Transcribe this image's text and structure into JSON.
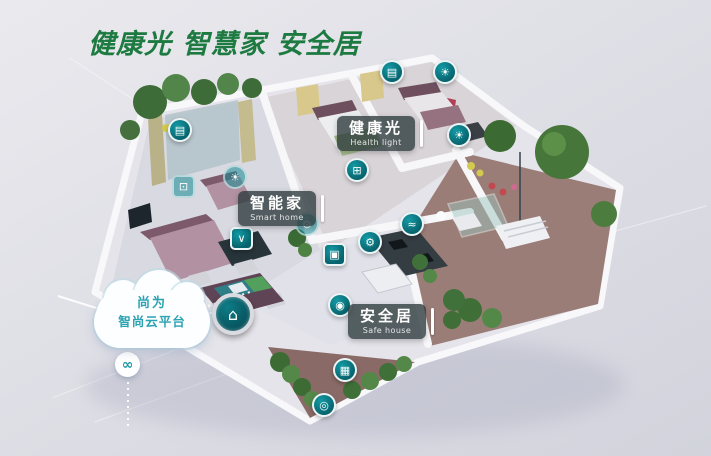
{
  "title": "健康光 智慧家 安全居",
  "cloud": {
    "line1": "尚为",
    "line2": "智尚云平台"
  },
  "tags": {
    "health_light": {
      "zh": "健康光",
      "en": "Health light"
    },
    "smart_home": {
      "zh": "智能家",
      "en": "Smart home"
    },
    "safe_house": {
      "zh": "安全居",
      "en": "Safe house"
    }
  },
  "icons": [
    {
      "name": "curtain-icon",
      "glyph": "▤"
    },
    {
      "name": "blind-icon",
      "glyph": "▤"
    },
    {
      "name": "ceiling-light-icon",
      "glyph": "☀"
    },
    {
      "name": "wall-light-icon",
      "glyph": "☀"
    },
    {
      "name": "switch-panel-icon",
      "glyph": "⊞"
    },
    {
      "name": "lamp-icon",
      "glyph": "☀"
    },
    {
      "name": "tv-icon",
      "glyph": "⊡"
    },
    {
      "name": "robot-vacuum-icon",
      "glyph": "∨"
    },
    {
      "name": "fresh-air-icon",
      "glyph": "≈"
    },
    {
      "name": "gear-icon",
      "glyph": "⚙"
    },
    {
      "name": "door-access-icon",
      "glyph": "▣"
    },
    {
      "name": "env-sensor-icon",
      "glyph": "⊙"
    },
    {
      "name": "guard-icon",
      "glyph": "◉"
    },
    {
      "name": "camera-icon",
      "glyph": "▦"
    },
    {
      "name": "doorbell-icon",
      "glyph": "◎"
    },
    {
      "name": "hub-icon",
      "glyph": "⌂"
    },
    {
      "name": "link-icon",
      "glyph": "∞"
    }
  ],
  "colors": {
    "title_green": "#1d7a40",
    "icon_teal": "#0b7680",
    "cloud_text_teal": "#2aa3b2",
    "label_bg": "rgba(43,56,59,0.78)",
    "background_gray": "#dcdde4",
    "garden_floor": "#9b7d78",
    "furniture_mauve": "#b292a2"
  }
}
